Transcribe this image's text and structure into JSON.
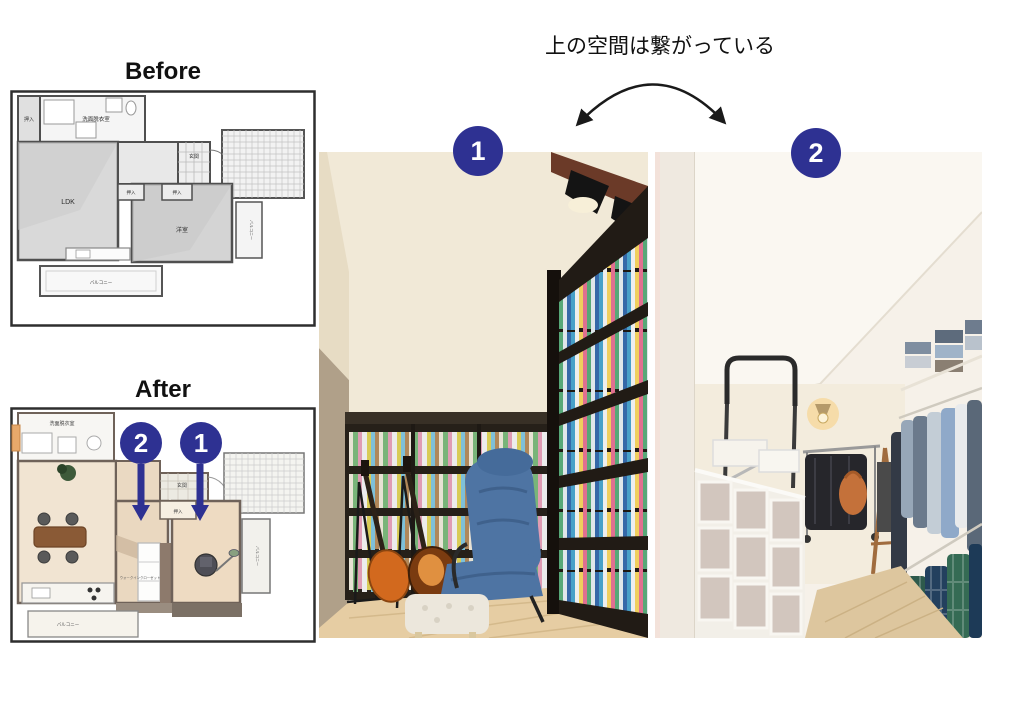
{
  "caption": "上の空間は繋がっている",
  "before": {
    "title": "Before",
    "labels": {
      "washroom": "洗面脱衣室",
      "closet": "押入",
      "ldk": "LDK",
      "entrance": "玄関",
      "bedroom": "洋室",
      "balcony": "バルコニー"
    }
  },
  "after": {
    "title": "After",
    "labels": {
      "washroom": "洗面脱衣室",
      "entrance": "玄関",
      "closet": "押入",
      "walk_in_closet": "ウォークインクローゼット",
      "balcony": "バルコニー"
    },
    "markers": {
      "one": "1",
      "two": "2"
    }
  },
  "photos": {
    "one_badge": "1",
    "two_badge": "2"
  },
  "colors": {
    "badge": "#2e3192",
    "arrow": "#1a1a1a"
  }
}
